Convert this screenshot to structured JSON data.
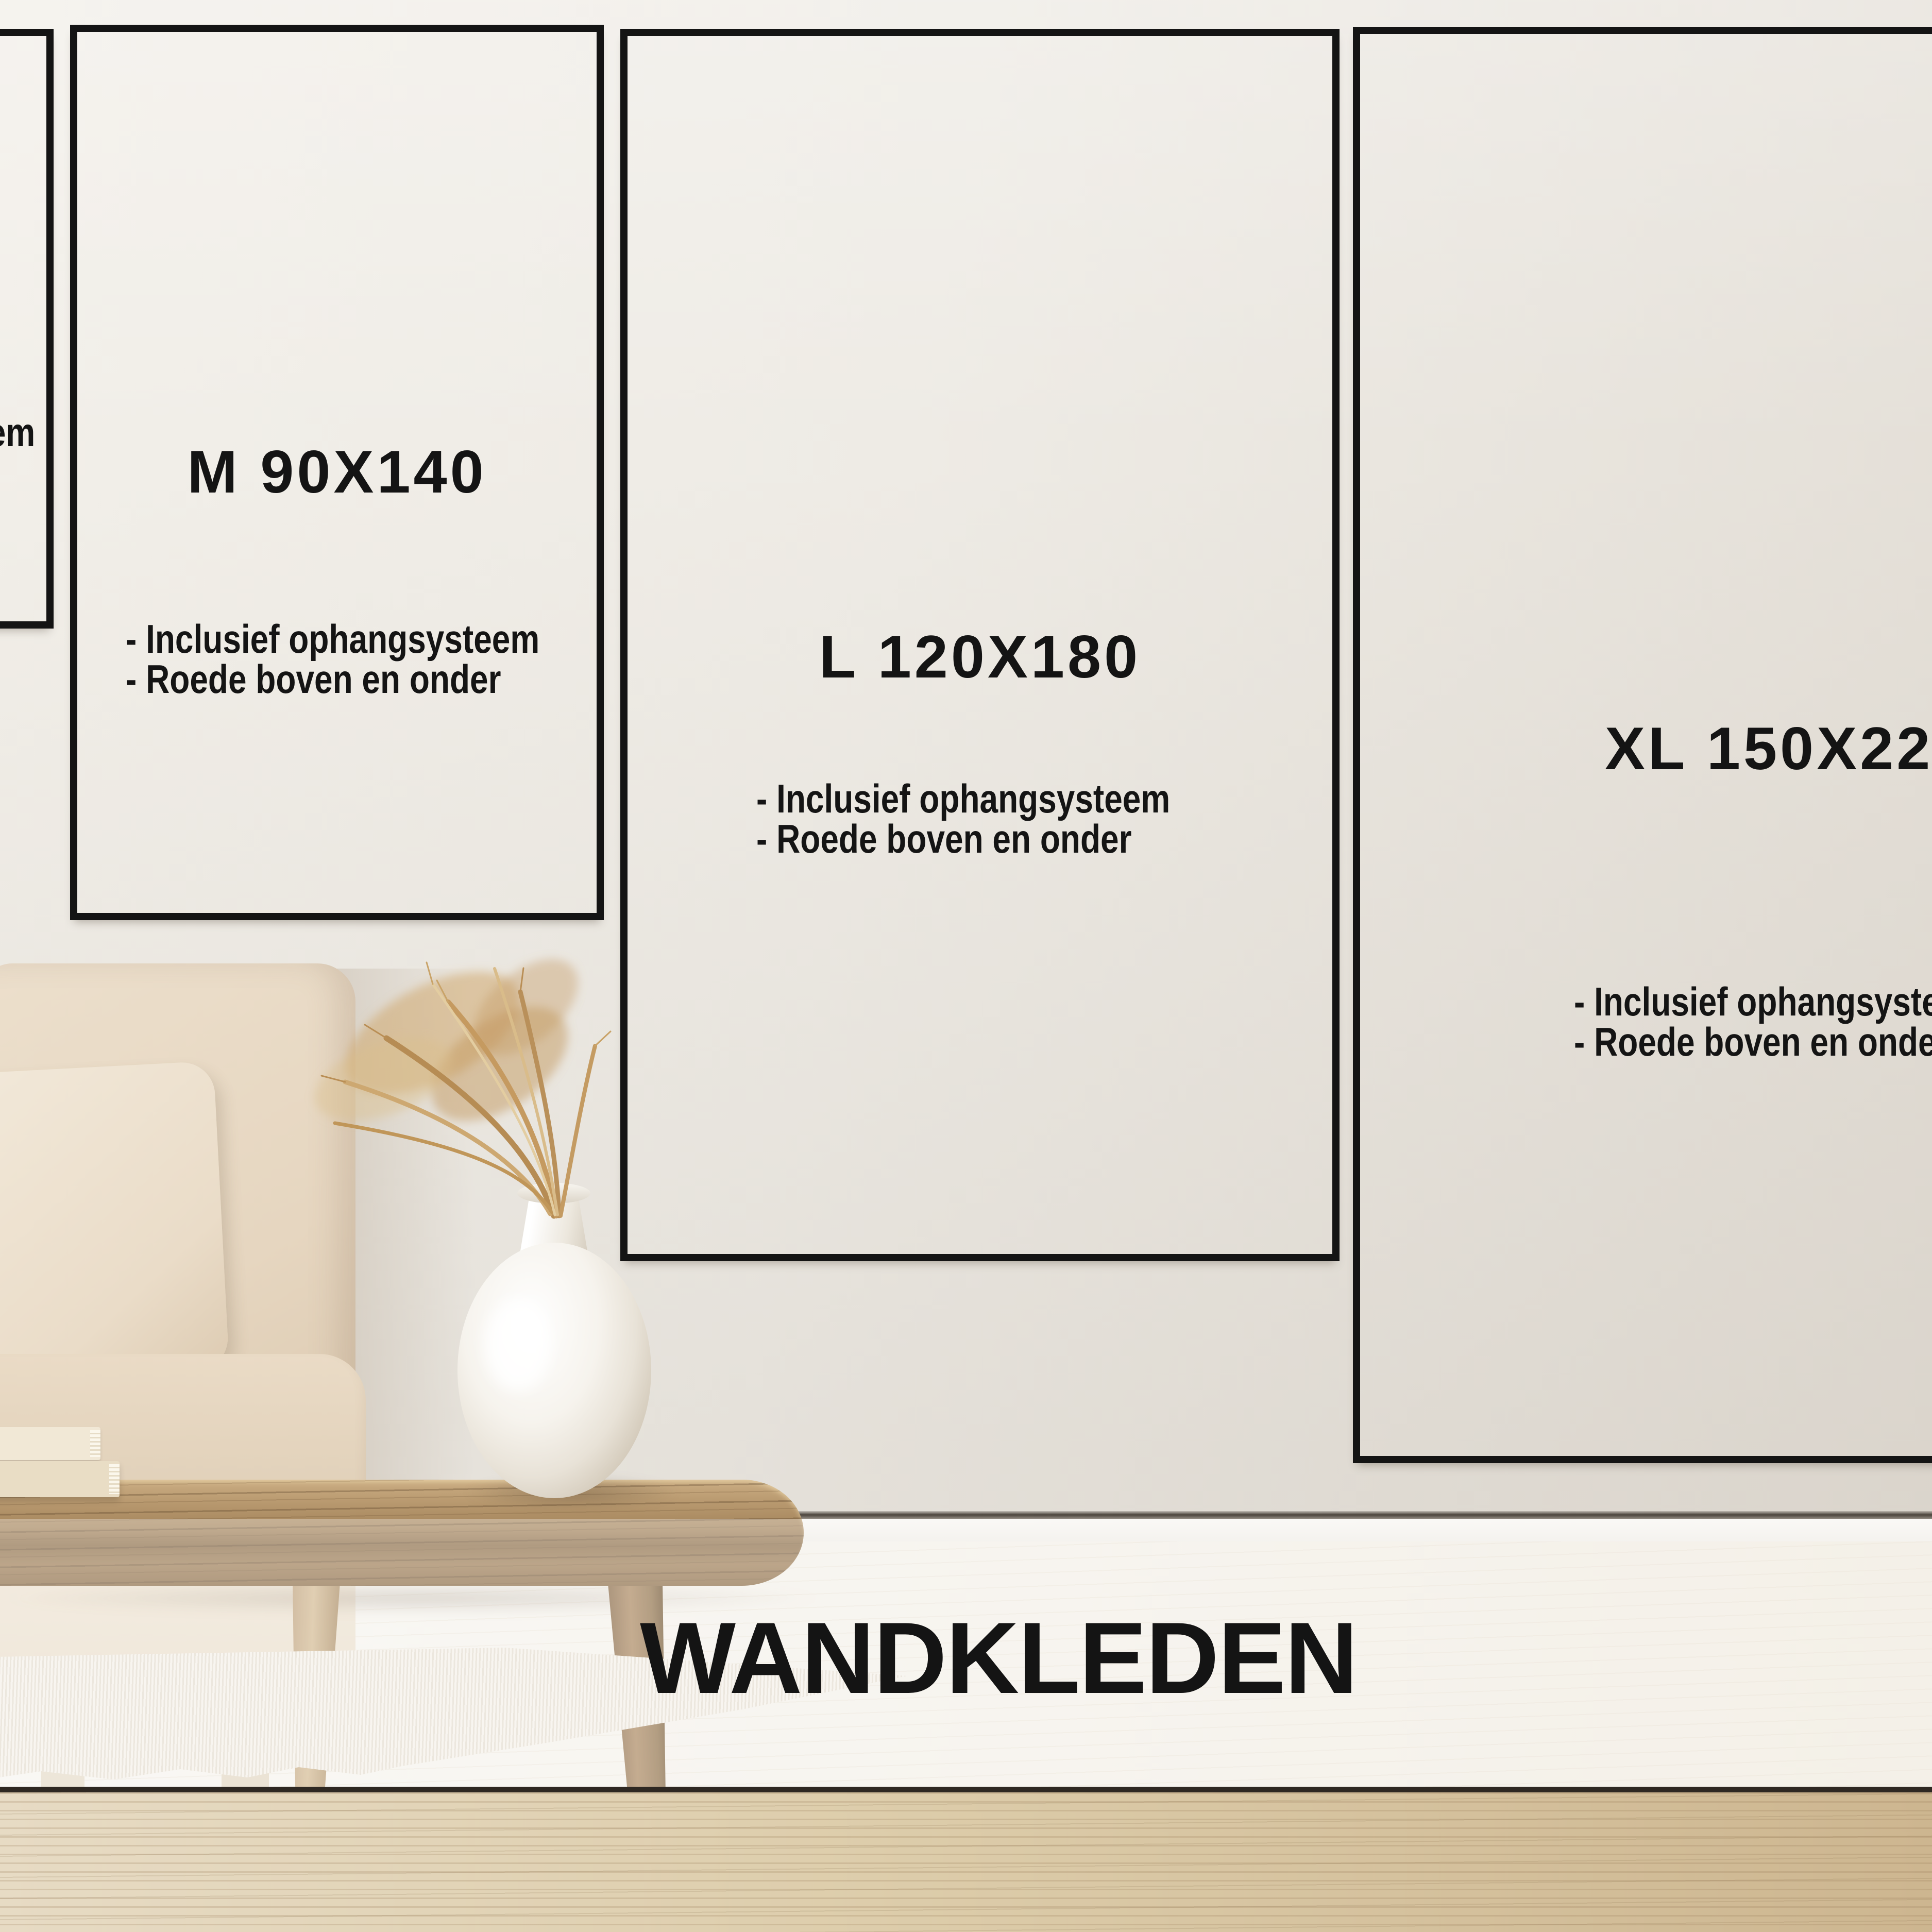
{
  "page_title": "WANDKLEDEN",
  "sizes": [
    {
      "label": "",
      "bullets": [
        "- Inclusief ophangsysteem",
        "- Roede boven en onder"
      ]
    },
    {
      "label": "M 90X140",
      "bullets": [
        "- Inclusief ophangsysteem",
        "- Roede boven en onder"
      ]
    },
    {
      "label": "L 120X180",
      "bullets": [
        "- Inclusief ophangsysteem",
        "- Roede boven en onder"
      ]
    },
    {
      "label": "XL 150X220",
      "bullets": [
        "- Inclusief ophangsysteem",
        "- Roede boven en onder"
      ]
    }
  ],
  "scene": {
    "decor": [
      "sofa",
      "pillow",
      "books",
      "coffee-table",
      "vase",
      "pampas-grass",
      "rug"
    ]
  },
  "colors": {
    "ink": "#141414",
    "wall": "#efece6",
    "wall_dark": "#e0dbd3",
    "floor": "#f4f1ea",
    "baseboard": "#f6f4f0",
    "shadow_line": "#4a433b",
    "ledge_line": "#2e2822",
    "ledge_wood": "#dcc9a6",
    "sofa": "#e7d8c3",
    "pillow": "#ede2d1",
    "table_wood": "#a9855c",
    "vase": "#f4f1ea",
    "grass": "#c69d66",
    "rug": "#f0ebe1"
  }
}
